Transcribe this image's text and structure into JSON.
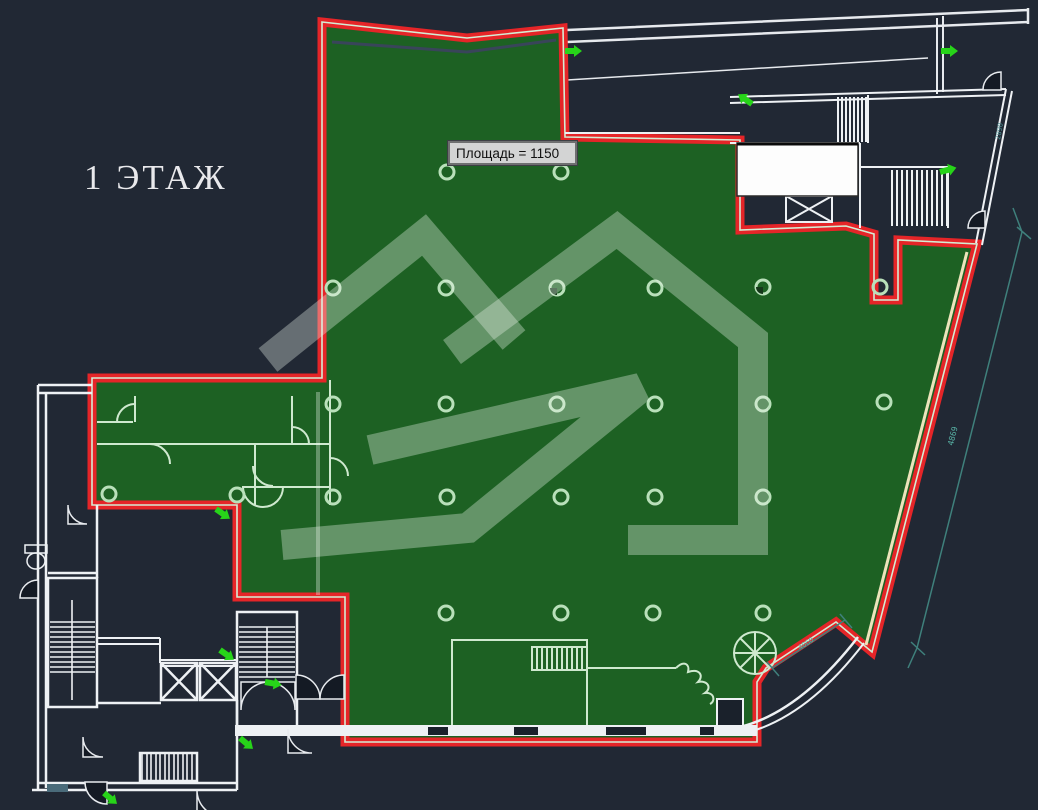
{
  "title": {
    "floor_label": "1 ЭТАЖ"
  },
  "tooltip": {
    "text": "Площадь = 1150"
  },
  "dimensions": {
    "right_wall": "4869",
    "lower_right": "4060",
    "upper_right_wall": "2890"
  },
  "colors": {
    "background": "#212834",
    "selection_fill": "#1d6123",
    "selection_outline": "#e52528",
    "inner_wall_on_green": "#cfe9cf",
    "outer_wall_white": "#eef1f4",
    "accent_cream_wall": "#ece4bb",
    "dimension_teal": "#3f807c",
    "door_direction_arrow": "#27d419",
    "watermark": "rgba(237,247,238,0.34)",
    "tooltip_background": "#d3d4d4"
  }
}
